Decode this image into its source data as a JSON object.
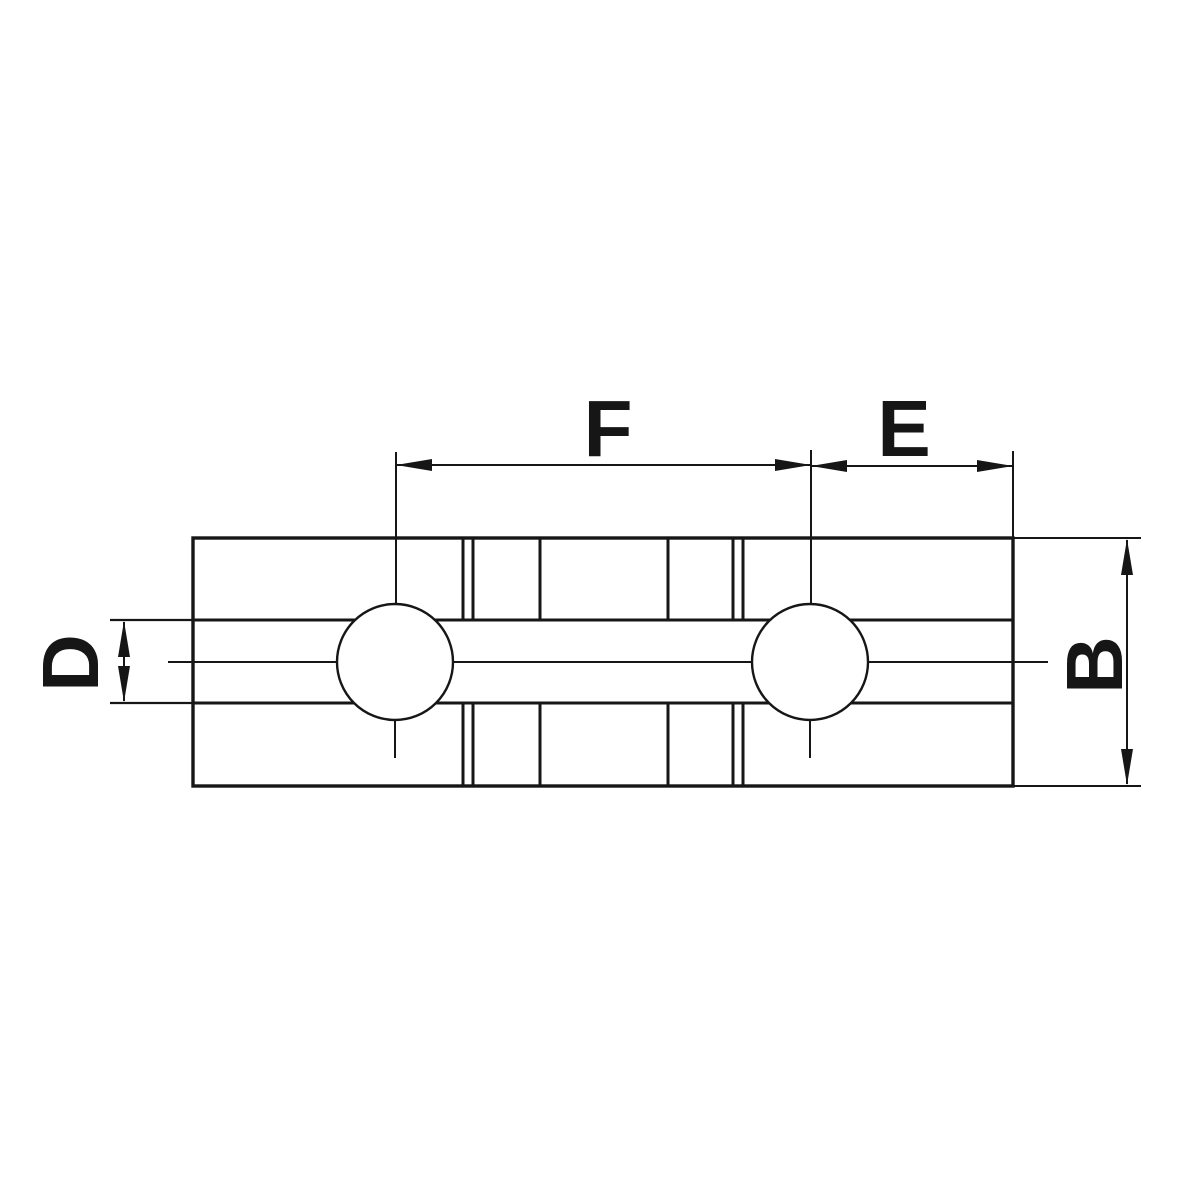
{
  "diagram": {
    "dimension_labels": {
      "f": "F",
      "e": "E",
      "d": "D",
      "b": "B"
    },
    "colors": {
      "line": "#161616",
      "background": "#ffffff"
    }
  }
}
